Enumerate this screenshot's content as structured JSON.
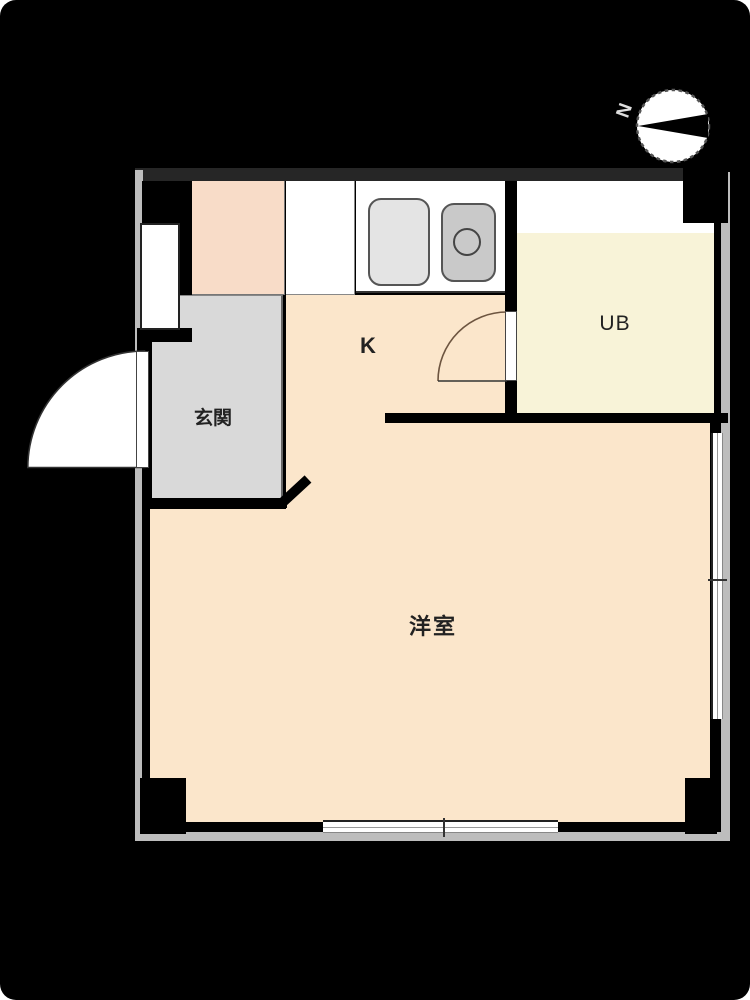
{
  "plan": {
    "title": "apartment-floor-plan",
    "rooms": {
      "kitchen": {
        "label": "K"
      },
      "unit_bath": {
        "label": "UB"
      },
      "entrance": {
        "label": "玄関"
      },
      "western_room": {
        "label": "洋室"
      }
    },
    "compass": {
      "label": "N",
      "direction": "left"
    },
    "fixtures": [
      "kitchen-counter",
      "sink",
      "drain",
      "entrance-door",
      "bath-door",
      "sliding-window-bottom",
      "sliding-window-right",
      "window-left"
    ],
    "colors": {
      "background": "#000000",
      "floor_peach": "#fbe6cb",
      "closet_pink": "#f8dcc8",
      "bath_cream": "#f8f3d8",
      "entrance_gray": "#d9d9d9",
      "sink_light": "#e4e4e4",
      "sink_dark": "#c9c9c9",
      "outline_gray": "#bdbdbd",
      "wall_black": "#000000",
      "top_wall": "#262626",
      "arc_line": "#6d5540"
    }
  }
}
